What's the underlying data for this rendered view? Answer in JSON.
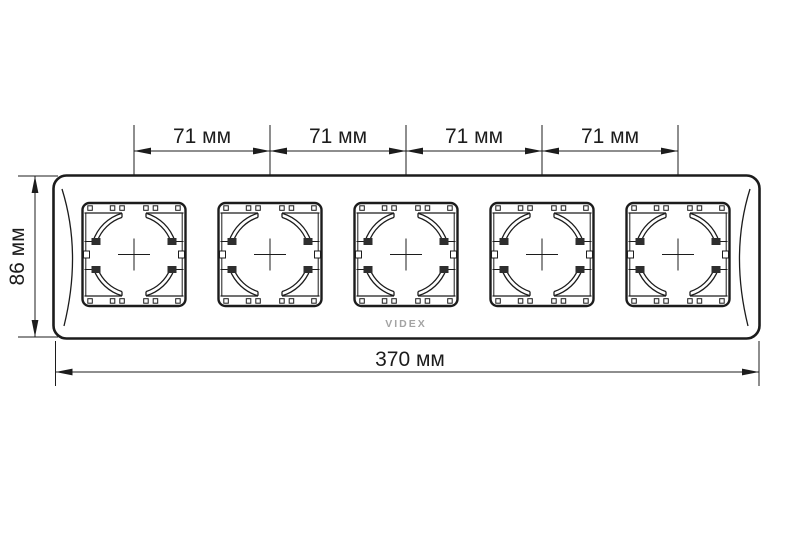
{
  "logo": {
    "text": "VIDEX"
  },
  "dimensions": {
    "top": [
      "71 мм",
      "71 мм",
      "71 мм",
      "71 мм"
    ],
    "bottom": "370 мм",
    "left": "86 мм"
  },
  "colors": {
    "line": "#1c1c1c",
    "logo": "#a3a3a3",
    "background": "#ffffff"
  }
}
